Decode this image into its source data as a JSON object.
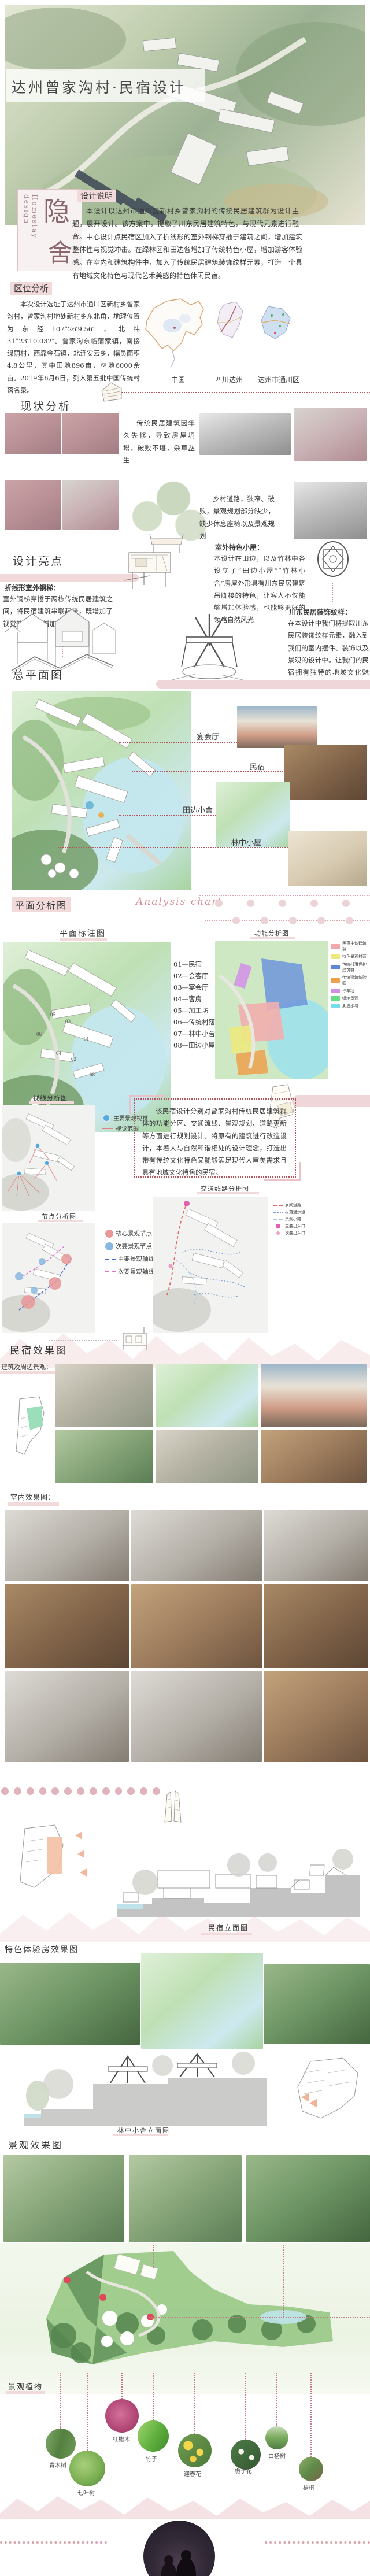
{
  "palette": {
    "accent_pink": "#f2d9da",
    "dusty_rose": "#d9a3ad",
    "deep_rose": "#b5525c",
    "ink": "#3c3c3c",
    "brand_maroon": "#8a686d"
  },
  "hero": {
    "title": "达州曾家沟村·民宿设计",
    "brand_en": "Homestay design",
    "brand_char_top": "隐",
    "brand_char_bottom": "舍"
  },
  "design_note": {
    "heading": "设计说明",
    "p1": "本设计以达州市通川区新村乡曾家沟村的传统民居建筑群为设计主题，展开设计。该方案中，提取了川东民居建筑特色，与现代元素进行融合。",
    "p2": "中心设计点民宿区加入了折线形的室外钢梯穿插于建筑之间，增加建筑整体性与视觉冲击。在绿林区和田边各增加了传统特色小屋，增加游客体验感。在室内和建筑构件中，加入了传统民居建筑装饰纹样元素，打造一个具有地域文化特色与现代艺术美感的特色休闲民宿。"
  },
  "location": {
    "heading": "区位分析",
    "paragraph": "本次设计选址于达州市通川区新村乡曾家沟村，曾家沟村地处新村乡东北角，地理位置为东经107°26′9.56″，北纬31°23′10.032″。曾家沟东临蒲家镇，南接绿荫村，西靠金石镇，北连安云乡，幅员面积4.8公里，其中田地896亩，林地6000余亩。2019年6月6日，列入第五批中国传统村落名录。",
    "maps": [
      {
        "label": "中国"
      },
      {
        "label": "四川达州"
      },
      {
        "label": "达州市通川区"
      }
    ]
  },
  "status": {
    "heading": "现状分析",
    "note1": "传统民居建筑因年久失修，导致房屋坍塌，破败不堪，杂草丛生",
    "note2": "乡村道路，狭窄、破败，景观规划部分缺少，缺少休息座椅以及景观规划"
  },
  "highlights": {
    "heading": "设计亮点",
    "items": [
      {
        "title": "折线形室外钢梯：",
        "text": "室外钢梯穿插于两栋传统民居建筑之间，将民宿建筑串联起来，既增加了视觉效果，也增加了民宿特色"
      },
      {
        "title": "室外特色小屋：",
        "text": "本设计在田边，以及竹林中各设立了“田边小屋”“竹林小舍”房屋外形具有川东民居建筑吊脚楼的特色，让客人不仅能够增加体验感，也能够更好的领略自然风光"
      },
      {
        "title": "川东民居装饰纹样：",
        "text": "在本设计中我们将提取川东民居装饰纹样元素，融入到我们的室内摆件、装饰以及景观的设计中。让我们的民宿拥有独特的地域文化魅力。"
      }
    ]
  },
  "masterplan": {
    "heading": "总平面图",
    "callouts": [
      {
        "label": "宴会厅"
      },
      {
        "label": "民宿"
      },
      {
        "label": "田边小舍"
      },
      {
        "label": "林中小屋"
      }
    ]
  },
  "plan_analysis": {
    "heading": "平面分析图",
    "chart_label": "Analysis chart",
    "annotation": {
      "title": "平面标注图",
      "legend": [
        "01—民宿",
        "02—会客厅",
        "03—宴会厅",
        "04—客房",
        "05—加工坊",
        "06—传统村落保护处",
        "07—林中小舍",
        "08—田边小屋"
      ]
    },
    "function": {
      "title": "功能分析图",
      "legend": [
        {
          "color": "#f2a9a9",
          "label": "民宿主体建筑群"
        },
        {
          "color": "#ece97f",
          "label": "特色景观村落"
        },
        {
          "color": "#5d88d4",
          "label": "传统村落保护建筑群"
        },
        {
          "color": "#eda14e",
          "label": "传统建筑体验区"
        },
        {
          "color": "#d28fe8",
          "label": "停车场"
        },
        {
          "color": "#64dd85",
          "label": "绿地景观"
        },
        {
          "color": "#79dcec",
          "label": "湖泊水域"
        }
      ]
    },
    "sight": {
      "title": "视线分析图",
      "legend": [
        {
          "label": "主要景观视觉"
        },
        {
          "label": "视觉范围"
        }
      ]
    },
    "node": {
      "title": "节点分析图",
      "legend": [
        {
          "label": "核心景观节点"
        },
        {
          "label": "次要景观节点"
        },
        {
          "label": "主要景观轴线"
        },
        {
          "label": "次要景观轴线"
        }
      ]
    },
    "traffic": {
      "title": "交通线路分析图",
      "legend": [
        {
          "label": "乡间道路"
        },
        {
          "label": "村落漫步道"
        },
        {
          "label": "景观小路"
        },
        {
          "label": "主要出入口"
        },
        {
          "label": "次要出入口"
        }
      ]
    },
    "summary": "该民宿设计分别对曾家沟村传统民居建筑群体的功能分区、交通流线、景观规划、道路更新等方面进行规划设计。将原有的建筑进行改造设计，本着人与自然和谐相处的设计理念，打造出带有传统文化特色又能够满足现代人审美需求且具有地域文化特色的民宿。"
  },
  "renderings": {
    "heading": "民宿效果图",
    "surroundings_label": "建筑及周边景观：",
    "interior_label": "室内效果图："
  },
  "elevations": {
    "homestay_caption": "民宿立面图",
    "cabin_caption": "林中小舍立面图"
  },
  "experience": {
    "heading": "特色体验房效果图"
  },
  "landscape": {
    "heading": "景观效果图"
  },
  "plants": {
    "heading": "景观植物",
    "items": [
      {
        "label": "青木树"
      },
      {
        "label": "七叶树"
      },
      {
        "label": "红檵木"
      },
      {
        "label": "竹子"
      },
      {
        "label": "迎春花"
      },
      {
        "label": "栀子花"
      },
      {
        "label": "白杨树"
      },
      {
        "label": "梧桐"
      }
    ]
  }
}
